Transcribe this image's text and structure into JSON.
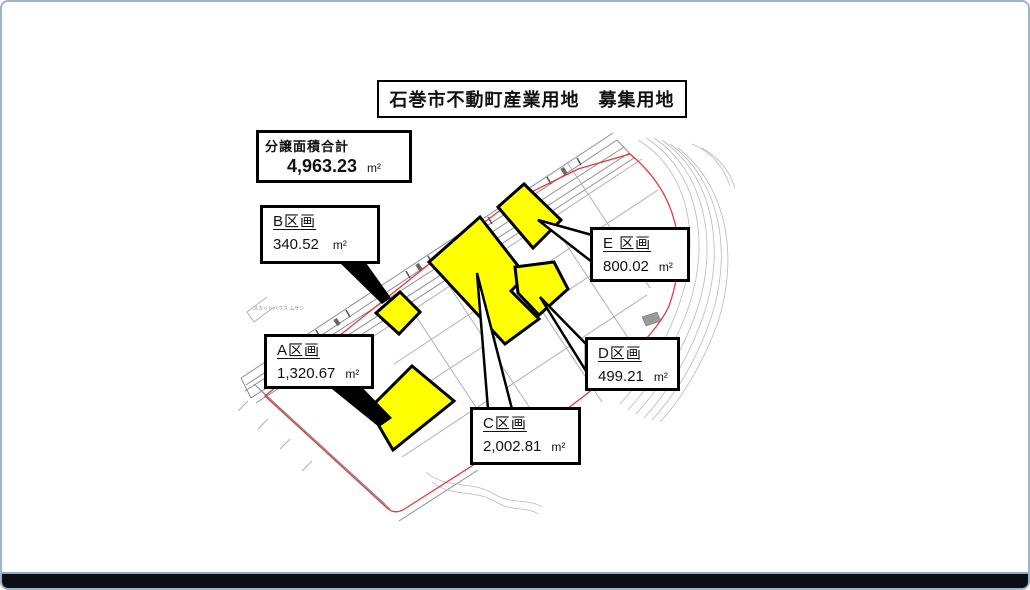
{
  "title": "石巻市不動町産業用地　募集用地",
  "summary": {
    "label": "分譲面積合計",
    "value": "4,963.23",
    "unit": "m²"
  },
  "plots": [
    {
      "id": "A",
      "label": "A区画",
      "area": "1,320.67",
      "unit": "m²"
    },
    {
      "id": "B",
      "label": "B区画",
      "area": "340.52",
      "unit": "m²"
    },
    {
      "id": "C",
      "label": "C区画",
      "area": "2,002.81",
      "unit": "m²"
    },
    {
      "id": "D",
      "label": "D区画",
      "area": "499.21",
      "unit": "m²"
    },
    {
      "id": "E",
      "label": "E 区画",
      "area": "800.02",
      "unit": "m²"
    }
  ],
  "map": {
    "tiny_annotation": "スカットハウス ムサシ"
  },
  "colors": {
    "plot_fill": "#ffff00",
    "plot_outline": "#000000",
    "site_boundary_red": "#e23b3b",
    "frame_border_blue": "#9db4cd",
    "bottom_bar_black": "#0b0e13"
  }
}
